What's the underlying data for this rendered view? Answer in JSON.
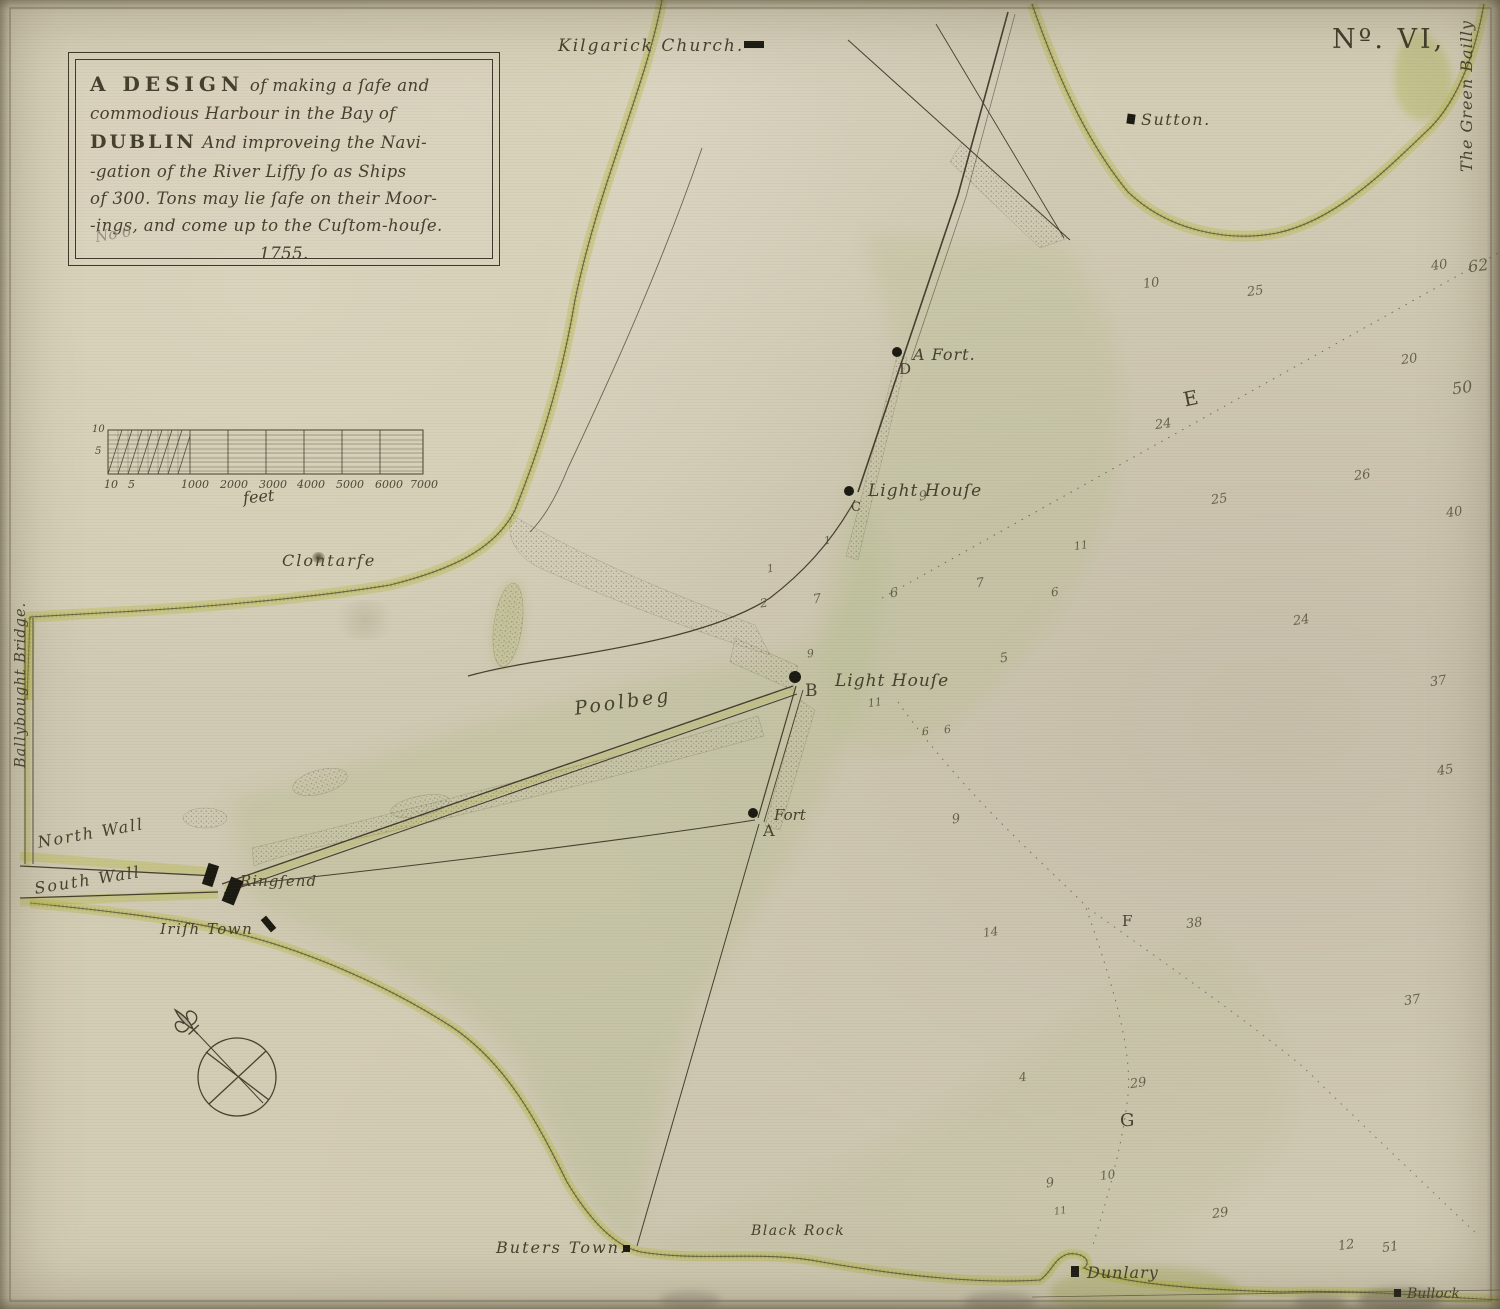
{
  "plate_number": "Nº. VI,",
  "cartouche": {
    "line1a": "A DESIGN",
    "line1b": "of making a ſafe and",
    "line2": "commodious Harbour in the Bay of",
    "line3a": "DUBLIN",
    "line3b": "And improveing the Navi-",
    "line4": "-gation of the River Liffy ſo as Ships",
    "line5": "of 300. Tons may lie ſafe on their Moor-",
    "line6": "-ings, and come up to the Cuſtom-houſe.",
    "year": "1755.",
    "pencil_note": "No 6"
  },
  "scale_bar": {
    "unit_label": "feet",
    "ticks": [
      {
        "t": "10",
        "x": 104
      },
      {
        "t": "5",
        "x": 128
      },
      {
        "t": "1000",
        "x": 181
      },
      {
        "t": "2000",
        "x": 220
      },
      {
        "t": "3000",
        "x": 259
      },
      {
        "t": "4000",
        "x": 297
      },
      {
        "t": "5000",
        "x": 336
      },
      {
        "t": "6000",
        "x": 375
      },
      {
        "t": "7000",
        "x": 410
      }
    ],
    "side_ticks": [
      {
        "t": "10",
        "x": 92,
        "y": 424
      },
      {
        "t": "5",
        "x": 95,
        "y": 446
      }
    ]
  },
  "places": [
    {
      "name": "kilgarick-church-label",
      "label": "Kilgarick Church.",
      "x": 558,
      "y": 36,
      "fs": 17,
      "ls": 2
    },
    {
      "name": "sutton-label",
      "label": "Sutton.",
      "x": 1141,
      "y": 110,
      "fs": 16,
      "ls": 1.5
    },
    {
      "name": "green-bailly-label",
      "label": "The Green Bailly",
      "x": 1457,
      "y": 172,
      "fs": 16,
      "rot": -90,
      "ls": 1
    },
    {
      "name": "ballybought-bridge-label",
      "label": "Ballybought Bridge.",
      "x": 13,
      "y": 768,
      "fs": 14.5,
      "rot": -90,
      "ls": 1
    },
    {
      "name": "a-fort-label",
      "label": "A Fort.",
      "x": 913,
      "y": 345,
      "fs": 16,
      "ls": 1
    },
    {
      "name": "letter-d",
      "label": "D",
      "x": 899,
      "y": 360,
      "fs": 15,
      "cls": "roman"
    },
    {
      "name": "lighthouse-c-label",
      "label": "Light Houſe",
      "x": 868,
      "y": 481,
      "fs": 17,
      "ls": 1
    },
    {
      "name": "letter-c",
      "label": "C",
      "x": 851,
      "y": 500,
      "fs": 13,
      "cls": "roman"
    },
    {
      "name": "lighthouse-b-label",
      "label": "Light Houſe",
      "x": 835,
      "y": 671,
      "fs": 17,
      "ls": 1
    },
    {
      "name": "letter-b",
      "label": "B",
      "x": 805,
      "y": 681,
      "fs": 17,
      "cls": "roman"
    },
    {
      "name": "fort-a-label",
      "label": "Fort",
      "x": 774,
      "y": 806,
      "fs": 15
    },
    {
      "name": "letter-a",
      "label": "A",
      "x": 763,
      "y": 821,
      "fs": 16,
      "cls": "roman"
    },
    {
      "name": "clontarfe-label",
      "label": "Clontarfe",
      "x": 282,
      "y": 551,
      "fs": 16,
      "ls": 2
    },
    {
      "name": "north-wall-label",
      "label": "North Wall",
      "x": 36,
      "y": 833,
      "fs": 16,
      "rot": -10,
      "ls": 2
    },
    {
      "name": "south-wall-label",
      "label": "South Wall",
      "x": 33,
      "y": 879,
      "fs": 16,
      "rot": -9,
      "ls": 2
    },
    {
      "name": "ringsend-label",
      "label": "Ringſend",
      "x": 240,
      "y": 872,
      "fs": 15,
      "ls": 1
    },
    {
      "name": "irish-town-label",
      "label": "Iriſh Town",
      "x": 160,
      "y": 920,
      "fs": 15,
      "ls": 1.5
    },
    {
      "name": "poolbeg-label",
      "label": "Poolbeg",
      "x": 573,
      "y": 698,
      "fs": 19,
      "rot": -8,
      "ls": 3
    },
    {
      "name": "buters-town-label",
      "label": "Buters Town.",
      "x": 496,
      "y": 1238,
      "fs": 16,
      "ls": 2
    },
    {
      "name": "black-rock-label",
      "label": "Black Rock",
      "x": 751,
      "y": 1223,
      "fs": 14,
      "ls": 1.5
    },
    {
      "name": "dunlary-label",
      "label": "Dunlary",
      "x": 1087,
      "y": 1263,
      "fs": 16,
      "ls": 1
    },
    {
      "name": "bullock-label",
      "label": "Bullock",
      "x": 1407,
      "y": 1286,
      "fs": 14
    },
    {
      "name": "letter-e",
      "label": "E",
      "x": 1181,
      "y": 388,
      "fs": 20,
      "rot": -12,
      "cls": "roman"
    },
    {
      "name": "letter-f",
      "label": "F",
      "x": 1122,
      "y": 912,
      "fs": 15,
      "cls": "roman"
    },
    {
      "name": "letter-g",
      "label": "G",
      "x": 1120,
      "y": 1110,
      "fs": 18,
      "cls": "roman"
    }
  ],
  "markers": [
    {
      "name": "kilgarick-church-marker",
      "type": "bar",
      "x": 744,
      "y": 41,
      "w": 20,
      "h": 7,
      "rot": 0
    },
    {
      "name": "sutton-marker",
      "type": "bar",
      "x": 1127,
      "y": 114,
      "w": 8,
      "h": 10,
      "rot": 8
    },
    {
      "name": "a-fort-dot",
      "type": "dot",
      "x": 897,
      "y": 352,
      "r": 5
    },
    {
      "name": "lighthouse-c-dot",
      "type": "dot",
      "x": 849,
      "y": 491,
      "r": 5
    },
    {
      "name": "lighthouse-b-dot",
      "type": "dot",
      "x": 795,
      "y": 677,
      "r": 6
    },
    {
      "name": "fort-a-dot",
      "type": "dot",
      "x": 753,
      "y": 813,
      "r": 5
    },
    {
      "name": "ringsend-marker-1",
      "type": "bar",
      "x": 205,
      "y": 864,
      "w": 11,
      "h": 22,
      "rot": 18
    },
    {
      "name": "ringsend-marker-2",
      "type": "bar",
      "x": 226,
      "y": 878,
      "w": 13,
      "h": 26,
      "rot": 22
    },
    {
      "name": "irish-town-marker",
      "type": "bar",
      "x": 265,
      "y": 916,
      "w": 7,
      "h": 16,
      "rot": -40
    },
    {
      "name": "buters-town-marker",
      "type": "bar",
      "x": 623,
      "y": 1245,
      "w": 7,
      "h": 7,
      "rot": 0
    },
    {
      "name": "dunlary-marker",
      "type": "bar",
      "x": 1071,
      "y": 1266,
      "w": 8,
      "h": 11,
      "rot": 0
    },
    {
      "name": "bullock-marker",
      "type": "bar",
      "x": 1394,
      "y": 1289,
      "w": 7,
      "h": 8,
      "rot": 0
    }
  ],
  "soundings": [
    {
      "v": "10",
      "x": 1143,
      "y": 276
    },
    {
      "v": "25",
      "x": 1247,
      "y": 284
    },
    {
      "v": "40",
      "x": 1431,
      "y": 258
    },
    {
      "v": "62",
      "x": 1468,
      "y": 256,
      "fs": 16
    },
    {
      "v": "20",
      "x": 1401,
      "y": 352
    },
    {
      "v": "50",
      "x": 1452,
      "y": 378,
      "fs": 16
    },
    {
      "v": "24",
      "x": 1155,
      "y": 417
    },
    {
      "v": "26",
      "x": 1354,
      "y": 468
    },
    {
      "v": "25",
      "x": 1211,
      "y": 492
    },
    {
      "v": "40",
      "x": 1446,
      "y": 505
    },
    {
      "v": "9",
      "x": 919,
      "y": 489
    },
    {
      "v": "11",
      "x": 1074,
      "y": 539,
      "fs": 11
    },
    {
      "v": "24",
      "x": 1293,
      "y": 613
    },
    {
      "v": "37",
      "x": 1430,
      "y": 674
    },
    {
      "v": "45",
      "x": 1437,
      "y": 763
    },
    {
      "v": "1",
      "x": 824,
      "y": 534,
      "fs": 11
    },
    {
      "v": "1",
      "x": 767,
      "y": 562,
      "fs": 11
    },
    {
      "v": "2",
      "x": 760,
      "y": 596,
      "fs": 12
    },
    {
      "v": "7",
      "x": 813,
      "y": 592
    },
    {
      "v": "6",
      "x": 890,
      "y": 586
    },
    {
      "v": "7",
      "x": 976,
      "y": 576
    },
    {
      "v": "6",
      "x": 1051,
      "y": 585,
      "fs": 12
    },
    {
      "v": "9",
      "x": 807,
      "y": 647,
      "fs": 11
    },
    {
      "v": "5",
      "x": 1000,
      "y": 651
    },
    {
      "v": "11",
      "x": 868,
      "y": 696,
      "fs": 11
    },
    {
      "v": "6",
      "x": 922,
      "y": 725,
      "fs": 11
    },
    {
      "v": "6",
      "x": 944,
      "y": 723,
      "fs": 11
    },
    {
      "v": "9",
      "x": 952,
      "y": 812
    },
    {
      "v": "14",
      "x": 983,
      "y": 925,
      "fs": 12
    },
    {
      "v": "38",
      "x": 1186,
      "y": 916
    },
    {
      "v": "37",
      "x": 1404,
      "y": 993
    },
    {
      "v": "4",
      "x": 1019,
      "y": 1070,
      "fs": 12
    },
    {
      "v": "29",
      "x": 1130,
      "y": 1076
    },
    {
      "v": "9",
      "x": 1046,
      "y": 1176
    },
    {
      "v": "10",
      "x": 1100,
      "y": 1168,
      "fs": 12
    },
    {
      "v": "11",
      "x": 1054,
      "y": 1206,
      "fs": 10
    },
    {
      "v": "29",
      "x": 1212,
      "y": 1206
    },
    {
      "v": "12",
      "x": 1338,
      "y": 1238
    },
    {
      "v": "51",
      "x": 1382,
      "y": 1240
    }
  ],
  "colors": {
    "paper": "#d0c9b3",
    "ink": "#453f2f",
    "coast_yellow": "#b4b63b",
    "water_green": "#b7bd8e",
    "marker_black": "#1b1a12"
  }
}
